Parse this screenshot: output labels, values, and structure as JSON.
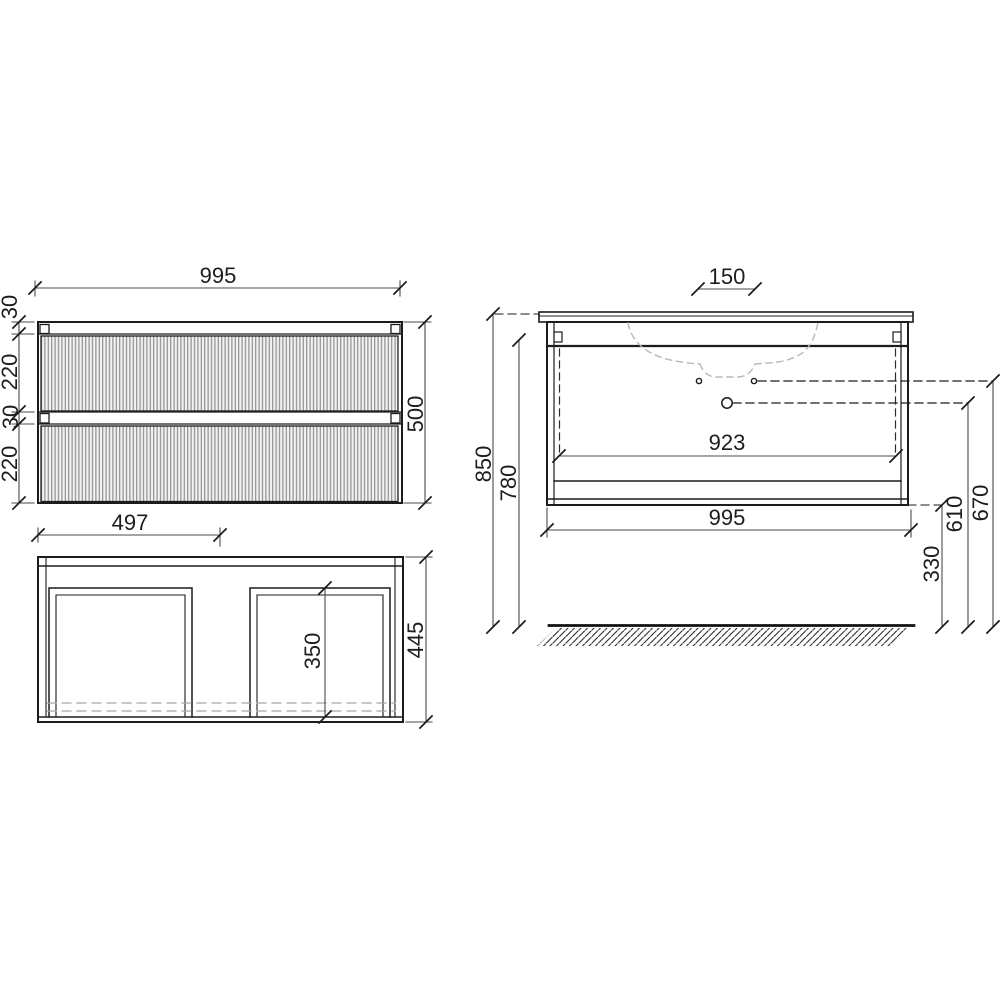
{
  "front_view": {
    "overall_width": "995",
    "top_frame": "30",
    "upper_drawer": "220",
    "middle_frame": "30",
    "lower_drawer": "220",
    "overall_height": "500"
  },
  "plan_view": {
    "drawer_module_width": "497",
    "overall_depth": "445",
    "inner_depth": "350"
  },
  "elevation": {
    "tap_hole_spacing": "150",
    "inner_clear_width": "923",
    "overall_width": "995",
    "height_to_basin_top": "850",
    "height_to_carcass_top": "780",
    "drain_outlet_height": "610",
    "water_supply_height": "670",
    "underside_clearance": "330"
  }
}
